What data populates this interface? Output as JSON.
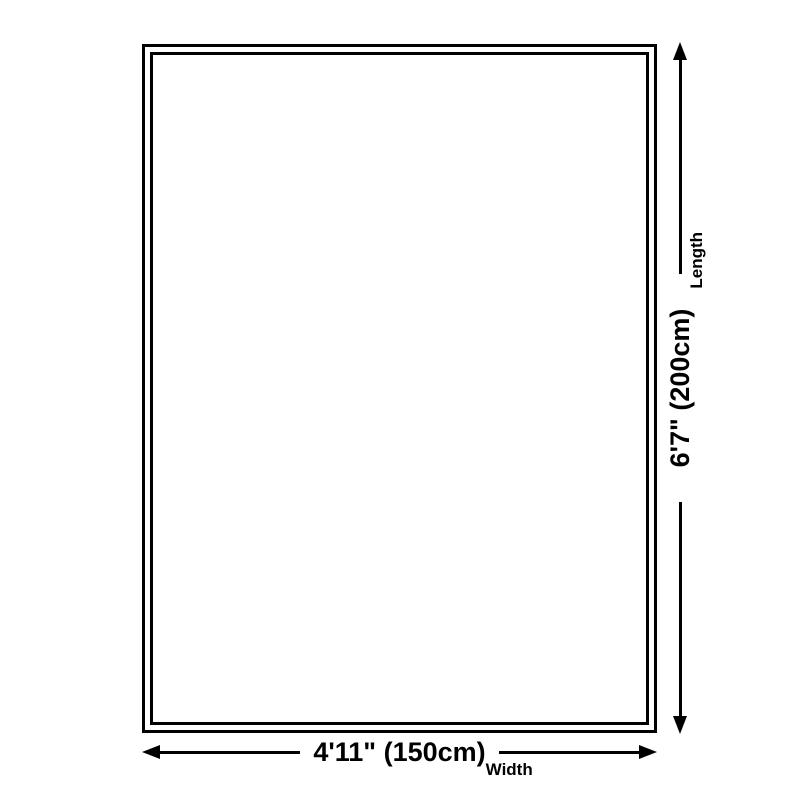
{
  "diagram": {
    "type": "product-size-diagram",
    "background_color": "#ffffff",
    "line_color": "#000000",
    "dimensions": {
      "length": {
        "value": "6'7\" (200cm)",
        "label": "Length",
        "orientation": "vertical"
      },
      "width": {
        "value": "4'11\" (150cm)",
        "label": "Width",
        "orientation": "horizontal"
      }
    }
  }
}
